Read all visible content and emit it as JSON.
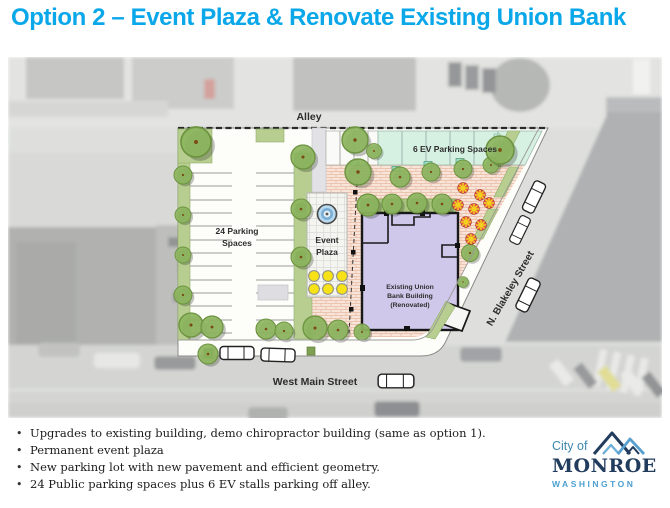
{
  "title": "Option 2 – Event Plaza & Renovate Existing Union Bank",
  "map": {
    "labels": {
      "alley": "Alley",
      "ev_parking": "6 EV Parking Spaces",
      "parking_line1": "24 Parking",
      "parking_line2": "Spaces",
      "event_line1": "Event",
      "event_line2": "Plaza",
      "building_line1": "Existing Union",
      "building_line2": "Bank Building",
      "building_line3": "(Renovated)",
      "west_main": "West Main Street",
      "blakeley": "N. Blakeley Street"
    }
  },
  "bullets": [
    "Upgrades to existing building, demo chiropractor building  (same as option 1).",
    "Permanent event  plaza",
    "New parking lot with new pavement and efficient geometry.",
    "24 Public parking spaces plus 6 EV stalls parking off alley."
  ],
  "logo": {
    "city_of": "City of",
    "name": "MONROE",
    "state": "WASHINGTON"
  },
  "colors": {
    "title_blue": "#0aa7e9",
    "logo_navy": "#223c5e",
    "logo_blue": "#4b9fd0",
    "building_purple": "#cfc8ea",
    "ev_mint": "#d6f0e2",
    "plaza_brick": "#f8e4d9",
    "tree_green": "#8cb55e",
    "strip_green": "#b8ce90",
    "table_yellow": "#f6e216"
  }
}
